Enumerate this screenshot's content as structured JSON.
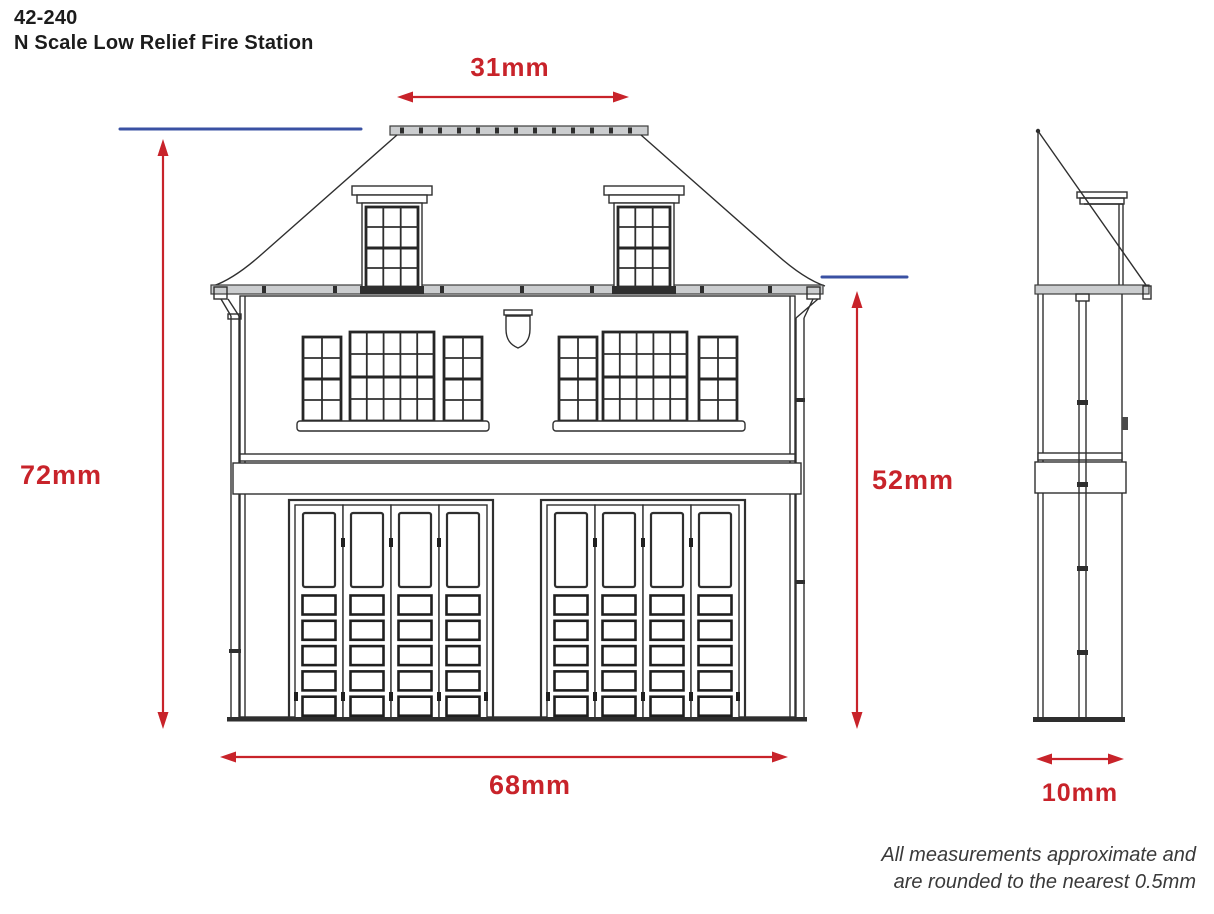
{
  "header": {
    "product_code": "42-240",
    "product_name": "N Scale Low Relief Fire Station"
  },
  "dimensions": {
    "ridge_width": "31mm",
    "overall_height": "72mm",
    "eaves_height": "52mm",
    "overall_width": "68mm",
    "depth": "10mm"
  },
  "footnote": {
    "line1": "All measurements approximate and",
    "line2": "are rounded to the nearest 0.5mm"
  },
  "colors": {
    "dimension_red": "#c8232a",
    "reference_blue": "#3a51a3",
    "drawing_ink": "#2f2f2f"
  }
}
